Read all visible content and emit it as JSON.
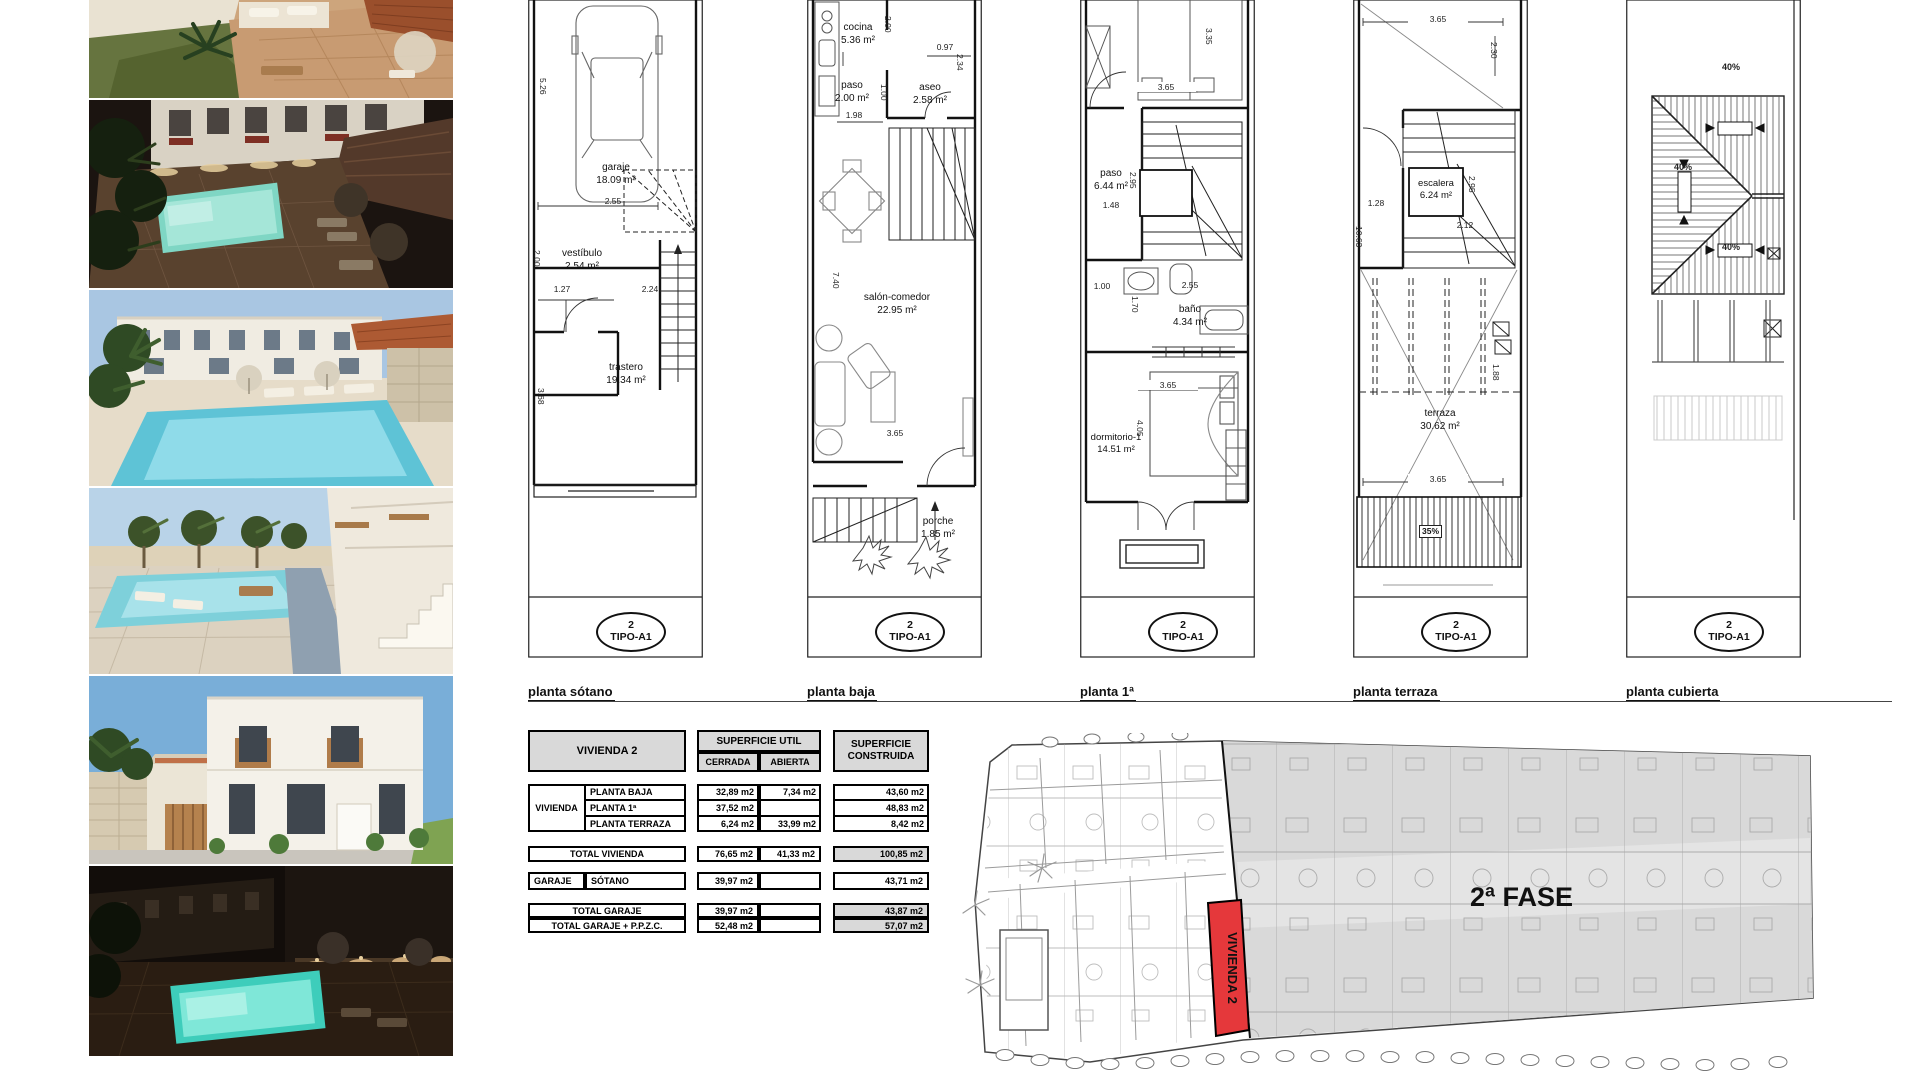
{
  "photos": [
    {
      "scene": "patio-palms-day-aerial"
    },
    {
      "scene": "pool-night-aerial"
    },
    {
      "scene": "pool-day-townhouses"
    },
    {
      "scene": "pool-day-walkway-stairs"
    },
    {
      "scene": "townhouse-facade-day"
    },
    {
      "scene": "pool-night-courtyard"
    }
  ],
  "plans": [
    {
      "caption": "planta sótano",
      "badge": {
        "number": "2",
        "type": "TIPO-A1"
      },
      "rooms": [
        {
          "name": "garaje",
          "area": "18.09 m²"
        },
        {
          "name": "vestíbulo",
          "area": "2.54 m²"
        },
        {
          "name": "trastero",
          "area": "19.34 m²"
        }
      ],
      "dims": [
        "5.26",
        "2.55",
        "2.00",
        "1.27",
        "2.24",
        "3.68"
      ]
    },
    {
      "caption": "planta baja",
      "badge": {
        "number": "2",
        "type": "TIPO-A1"
      },
      "rooms": [
        {
          "name": "cocina",
          "area": "5.36 m²"
        },
        {
          "name": "paso",
          "area": "2.00 m²"
        },
        {
          "name": "aseo",
          "area": "2.58 m²"
        },
        {
          "name": "salón-comedor",
          "area": "22.95 m²"
        },
        {
          "name": "porche",
          "area": "1.85 m²"
        }
      ],
      "dims": [
        "2.00",
        "0.97",
        "2.34",
        "1.00",
        "1.98",
        "7.40",
        "3.65"
      ]
    },
    {
      "caption": "planta 1ª",
      "badge": {
        "number": "2",
        "type": "TIPO-A1"
      },
      "rooms": [
        {
          "name": "paso",
          "area": "6.44 m²"
        },
        {
          "name": "baño",
          "area": "4.34 m²"
        },
        {
          "name": "dormitorio-1",
          "area": "14.51 m²"
        }
      ],
      "dims": [
        "3.35",
        "3.65",
        "2.95",
        "1.48",
        "1.00",
        "2.55",
        "1.70",
        "3.65",
        "4.05"
      ]
    },
    {
      "caption": "planta terraza",
      "badge": {
        "number": "2",
        "type": "TIPO-A1"
      },
      "rooms": [
        {
          "name": "escalera",
          "area": "6.24 m²"
        },
        {
          "name": "terraza",
          "area": "30.62 m²"
        }
      ],
      "dims": [
        "3.65",
        "2.30",
        "1.28",
        "2.12",
        "2.95",
        "10.63",
        "1.88",
        "3.65"
      ],
      "slope": "35%"
    },
    {
      "caption": "planta cubierta",
      "badge": {
        "number": "2",
        "type": "TIPO-A1"
      },
      "rooms": [],
      "slopes": [
        "40%",
        "40%",
        "40%"
      ]
    }
  ],
  "areas_table": {
    "title": "VIVIENDA 2",
    "util_header": "SUPERFICIE UTIL",
    "construida_header": "SUPERFICIE CONSTRUIDA",
    "cerrada_header": "CERRADA",
    "abierta_header": "ABIERTA",
    "group_label": "VIVIENDA",
    "rows": [
      {
        "label": "PLANTA BAJA",
        "cerrada": "32,89 m2",
        "abierta": "7,34 m2",
        "construida": "43,60 m2"
      },
      {
        "label": "PLANTA 1ª",
        "cerrada": "37,52 m2",
        "abierta": "",
        "construida": "48,83 m2"
      },
      {
        "label": "PLANTA TERRAZA",
        "cerrada": "6,24 m2",
        "abierta": "33,99 m2",
        "construida": "8,42 m2"
      }
    ],
    "total_vivienda": {
      "label": "TOTAL VIVIENDA",
      "cerrada": "76,65 m2",
      "abierta": "41,33 m2",
      "construida": "100,85 m2"
    },
    "garaje": {
      "group": "GARAJE",
      "label": "SÓTANO",
      "cerrada": "39,97 m2",
      "construida": "43,71 m2"
    },
    "total_garaje": {
      "label": "TOTAL GARAJE",
      "cerrada": "39,97 m2",
      "construida": "43,87 m2"
    },
    "total_garaje_ppzc": {
      "label": "TOTAL GARAJE + P.P.Z.C.",
      "cerrada": "52,48 m2",
      "construida": "57,07 m2"
    }
  },
  "site_plan": {
    "phase_label": "2ª FASE",
    "highlight_label": "VIVIENDA 2",
    "highlight_color": "#e5383b"
  }
}
